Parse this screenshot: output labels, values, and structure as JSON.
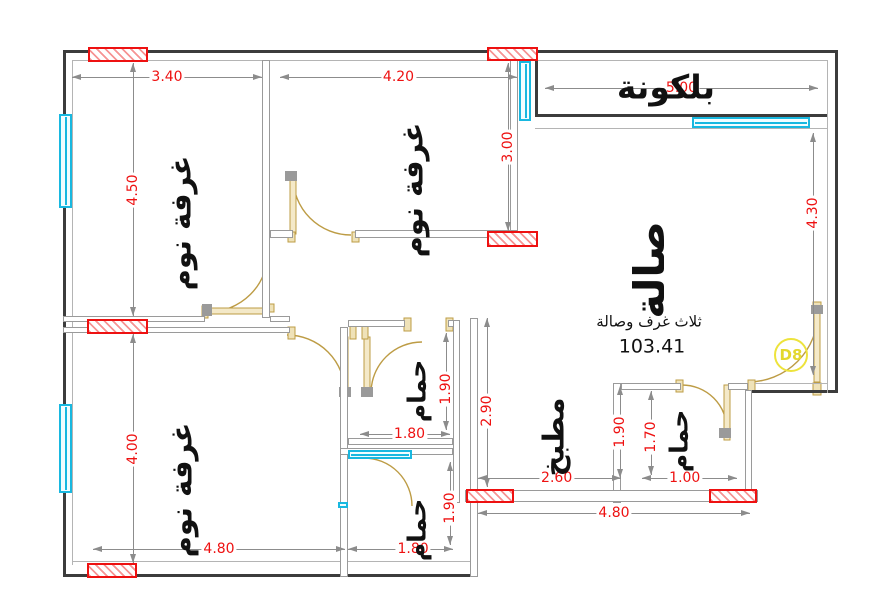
{
  "plan": {
    "canvas": {
      "w": 890,
      "h": 608
    },
    "door_tag": "D8",
    "summary": {
      "type_label": "ثلاث غرف وصالة",
      "area_value": "103.41"
    },
    "colors": {
      "exterior_wall": "#3c3c3c",
      "interior_wall": "#9a9a9a",
      "dimension_red": "#ee1111",
      "dimension_line": "#8c8c8c",
      "window_cyan": "#18b8e0",
      "door_tan": "#bd9c45",
      "opening_hatch_red": "#ee1111",
      "door_tag_yellow": "#ede33c",
      "text_black": "#111111"
    },
    "labels": [
      {
        "id": "room-label-bedroom-1",
        "text": "غرفة نوم",
        "x": 181,
        "y": 223,
        "deg": -90,
        "size": 29,
        "weight": "bold"
      },
      {
        "id": "room-label-bedroom-2",
        "text": "غرفة نوم",
        "x": 413,
        "y": 190,
        "deg": -90,
        "size": 29,
        "weight": "bold"
      },
      {
        "id": "room-label-bedroom-3",
        "text": "غرفة نوم",
        "x": 182,
        "y": 490,
        "deg": -90,
        "size": 29,
        "weight": "bold"
      },
      {
        "id": "room-label-hall",
        "text": "صالة",
        "x": 650,
        "y": 270,
        "deg": -90,
        "size": 42,
        "weight": "bold"
      },
      {
        "id": "room-label-balcony",
        "text": "بلكونة",
        "x": 666,
        "y": 87,
        "deg": 0,
        "size": 33,
        "weight": "bold"
      },
      {
        "id": "room-label-bath-1",
        "text": "حمام",
        "x": 417,
        "y": 391,
        "deg": -90,
        "size": 25,
        "weight": "bold"
      },
      {
        "id": "room-label-bath-2",
        "text": "حمام",
        "x": 417,
        "y": 530,
        "deg": -90,
        "size": 25,
        "weight": "bold"
      },
      {
        "id": "room-label-bath-3",
        "text": "حمام",
        "x": 679,
        "y": 441,
        "deg": -90,
        "size": 25,
        "weight": "bold"
      },
      {
        "id": "room-label-kitchen",
        "text": "مطبخ",
        "x": 554,
        "y": 437,
        "deg": -90,
        "size": 29,
        "weight": "bold"
      },
      {
        "id": "apartment-type-label",
        "text": "ثلاث غرف وصالة",
        "x": 649,
        "y": 322,
        "deg": 0,
        "size": 15,
        "weight": "normal"
      },
      {
        "id": "apartment-area-value",
        "text": "103.41",
        "x": 652,
        "y": 347,
        "deg": 0,
        "size": 19,
        "weight": "normal"
      }
    ],
    "dimensions": [
      {
        "v": "3.40",
        "o": "h",
        "x1": 72,
        "x2": 262,
        "y": 77,
        "lc": 0.5
      },
      {
        "v": "4.20",
        "o": "h",
        "x1": 280,
        "x2": 517,
        "y": 77,
        "lc": 0.5
      },
      {
        "v": "5.00",
        "o": "h",
        "x1": 545,
        "x2": 818,
        "y": 88,
        "lc": 0.5
      },
      {
        "v": "4.50",
        "o": "v",
        "x": 133,
        "y1": 63,
        "y2": 316,
        "lc": 0.5
      },
      {
        "v": "3.00",
        "o": "v",
        "x": 508,
        "y1": 63,
        "y2": 231,
        "lc": 0.5
      },
      {
        "v": "4.30",
        "o": "v",
        "x": 813,
        "y1": 133,
        "y2": 375,
        "lc": 0.33
      },
      {
        "v": "4.00",
        "o": "v",
        "x": 133,
        "y1": 334,
        "y2": 563,
        "lc": 0.5
      },
      {
        "v": "4.80",
        "o": "h",
        "x1": 93,
        "x2": 345,
        "y": 549,
        "lc": 0.5
      },
      {
        "v": "1.80",
        "o": "h",
        "x1": 348,
        "x2": 453,
        "y": 549,
        "lc": 0.62
      },
      {
        "v": "1.90",
        "o": "v",
        "x": 450,
        "y1": 462,
        "y2": 545,
        "lc": 0.55
      },
      {
        "v": "1.80",
        "o": "h",
        "x1": 360,
        "x2": 450,
        "y": 434,
        "lc": 0.55
      },
      {
        "v": "1.90",
        "o": "v",
        "x": 446,
        "y1": 333,
        "y2": 430,
        "lc": 0.58
      },
      {
        "v": "2.90",
        "o": "v",
        "x": 487,
        "y1": 318,
        "y2": 487,
        "lc": 0.55
      },
      {
        "v": "2.60",
        "o": "h",
        "x1": 478,
        "x2": 621,
        "y": 478,
        "lc": 0.55
      },
      {
        "v": "4.80",
        "o": "h",
        "x1": 478,
        "x2": 750,
        "y": 513,
        "lc": 0.5
      },
      {
        "v": "1.90",
        "o": "v",
        "x": 620,
        "y1": 386,
        "y2": 478,
        "lc": 0.5
      },
      {
        "v": "1.70",
        "o": "v",
        "x": 651,
        "y1": 391,
        "y2": 475,
        "lc": 0.55
      },
      {
        "v": "1.00",
        "o": "h",
        "x1": 642,
        "x2": 737,
        "y": 478,
        "lc": 0.45
      }
    ],
    "walls_exterior": [
      [
        63,
        50,
        775,
        3
      ],
      [
        63,
        50,
        3,
        527
      ],
      [
        63,
        574,
        415,
        3
      ],
      [
        835,
        50,
        3,
        343
      ],
      [
        748,
        390,
        90,
        3
      ],
      [
        535,
        60,
        3,
        57
      ],
      [
        535,
        114,
        292,
        3
      ]
    ],
    "wall_lines": [
      [
        72,
        60,
        756,
        1
      ],
      [
        72,
        60,
        1,
        505
      ],
      [
        72,
        561,
        401,
        1
      ],
      [
        827,
        60,
        1,
        333
      ],
      [
        535,
        128,
        292,
        1
      ],
      [
        755,
        383,
        73,
        1
      ]
    ],
    "walls_interior": [
      [
        262,
        60,
        8,
        258
      ],
      [
        270,
        230,
        23,
        8
      ],
      [
        355,
        230,
        162,
        8
      ],
      [
        510,
        60,
        8,
        171
      ],
      [
        63,
        316,
        142,
        6
      ],
      [
        270,
        316,
        20,
        6
      ],
      [
        63,
        327,
        227,
        6
      ],
      [
        340,
        327,
        8,
        250
      ],
      [
        348,
        320,
        57,
        7
      ],
      [
        448,
        320,
        12,
        7
      ],
      [
        453,
        320,
        7,
        183
      ],
      [
        348,
        438,
        105,
        7
      ],
      [
        340,
        448,
        113,
        7
      ],
      [
        470,
        318,
        8,
        185
      ],
      [
        613,
        383,
        8,
        120
      ],
      [
        621,
        383,
        60,
        7
      ],
      [
        728,
        383,
        20,
        7
      ],
      [
        745,
        390,
        7,
        113
      ],
      [
        465,
        490,
        293,
        12
      ],
      [
        470,
        502,
        8,
        75
      ]
    ],
    "windows": [
      {
        "x": 59,
        "y": 114,
        "w": 13,
        "h": 94,
        "axis": "v"
      },
      {
        "x": 59,
        "y": 404,
        "w": 13,
        "h": 89,
        "axis": "v"
      },
      {
        "x": 519,
        "y": 61,
        "w": 12,
        "h": 60,
        "axis": "v"
      },
      {
        "x": 692,
        "y": 117,
        "w": 118,
        "h": 11,
        "axis": "h"
      },
      {
        "x": 348,
        "y": 450,
        "w": 64,
        "h": 9,
        "axis": "h"
      },
      {
        "x": 338,
        "y": 502,
        "w": 10,
        "h": 6,
        "axis": "h"
      }
    ],
    "openings_hatched": [
      [
        88,
        47,
        60,
        15
      ],
      [
        487,
        47,
        51,
        14
      ],
      [
        487,
        231,
        51,
        16
      ],
      [
        87,
        319,
        61,
        15
      ],
      [
        87,
        563,
        50,
        15
      ],
      [
        466,
        489,
        48,
        14
      ],
      [
        709,
        489,
        48,
        14
      ]
    ],
    "doors": [
      {
        "arc": "M208,312 A60,60 0 0 0 268,252",
        "leaf": [
          208,
          308,
          60,
          6
        ]
      },
      {
        "arc": "M351,235 A58,58 0 0 1 293,177",
        "leaf": [
          290,
          177,
          6,
          57
        ]
      },
      {
        "arc": "M287,335 A58,58 0 0 1 345,393",
        "leaf": [
          342,
          337,
          6,
          57
        ]
      },
      {
        "arc": "M371,393 A51,51 0 0 1 422,342",
        "leaf": [
          364,
          337,
          6,
          57
        ]
      },
      {
        "arc": "M364,458 A48,48 0 0 1 412,506",
        "leaf": null
      },
      {
        "arc": "M682,385 A45,45 0 0 1 727,430",
        "leaf": [
          724,
          385,
          6,
          55
        ]
      },
      {
        "arc": "M818,312 A70,70 0 0 1 748,382",
        "leaf": [
          814,
          312,
          6,
          70
        ]
      }
    ],
    "door_jambs": [
      [
        202,
        306,
        6,
        12
      ],
      [
        266,
        304,
        8,
        8
      ],
      [
        288,
        232,
        7,
        10
      ],
      [
        352,
        232,
        7,
        10
      ],
      [
        288,
        327,
        7,
        12
      ],
      [
        350,
        325,
        6,
        14
      ],
      [
        362,
        325,
        6,
        14
      ],
      [
        404,
        318,
        7,
        13
      ],
      [
        446,
        318,
        7,
        13
      ],
      [
        676,
        380,
        7,
        12
      ],
      [
        748,
        380,
        7,
        12
      ],
      [
        813,
        302,
        8,
        10
      ],
      [
        813,
        383,
        8,
        12
      ]
    ],
    "door_hinges": [
      [
        202,
        304,
        10,
        12
      ],
      [
        285,
        171,
        12,
        10
      ],
      [
        339,
        387,
        12,
        10
      ],
      [
        361,
        387,
        12,
        10
      ],
      [
        719,
        428,
        12,
        10
      ],
      [
        811,
        305,
        12,
        9
      ]
    ],
    "badge": {
      "x": 791,
      "y": 355,
      "r": 17
    }
  }
}
